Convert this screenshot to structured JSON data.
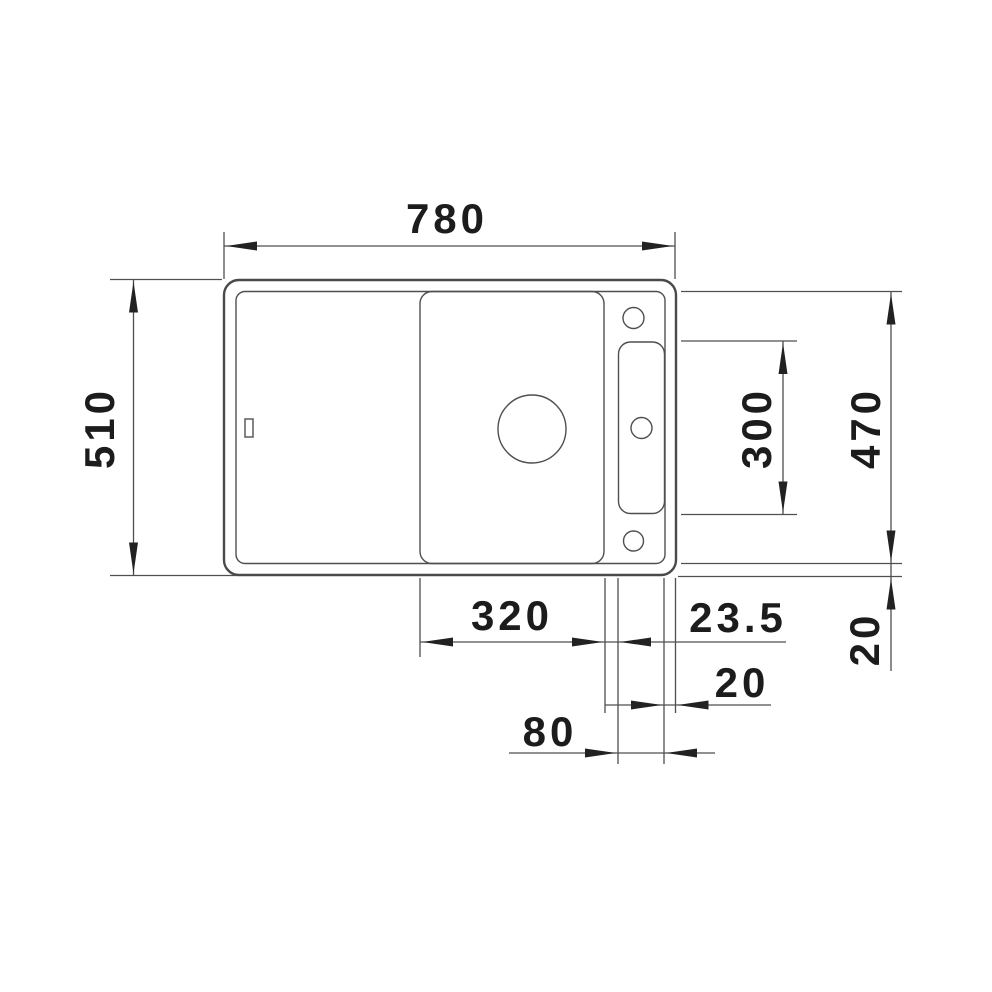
{
  "colors": {
    "line": "#4a4a4a",
    "text": "#1c1c1c",
    "background": "#ffffff"
  },
  "drawing": {
    "type": "technical-dimension-drawing",
    "subject": "sink-top-view",
    "dimensions": {
      "overall_width": "780",
      "overall_depth": "510",
      "working_depth": "470",
      "slot_length": "300",
      "board_width": "320",
      "board_to_slot_gap": "23.5",
      "slot_to_edge_gap": "20",
      "slot_width": "80",
      "rim_offset": "20"
    }
  }
}
